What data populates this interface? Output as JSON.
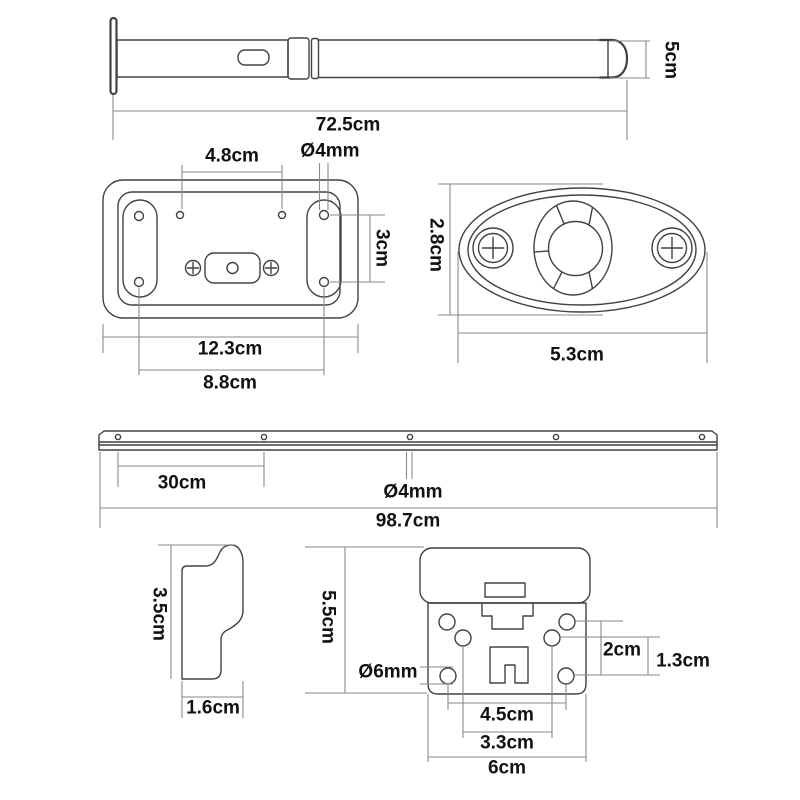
{
  "colors": {
    "background": "#ffffff",
    "outline": "#424242",
    "dimension_line": "#8a8a8a",
    "text": "#111111"
  },
  "figures": {
    "pole": {
      "title": "telescopic pole",
      "length": "72.5cm",
      "diameter": "5cm"
    },
    "plate": {
      "title": "rectangular mounting plate",
      "top_hole_spacing": "4.8cm",
      "hole_diameter": "Ø4mm",
      "side_hole_spacing": "3cm",
      "overall_width": "12.3cm",
      "hole_span": "8.8cm"
    },
    "oval_plate": {
      "title": "oval mounting plate",
      "height": "2.8cm",
      "width": "5.3cm"
    },
    "rail": {
      "title": "mounting rail",
      "hole_spacing": "30cm",
      "hole_diameter": "Ø4mm",
      "length": "98.7cm"
    },
    "profile": {
      "title": "hook profile",
      "height": "3.5cm",
      "depth": "1.6cm"
    },
    "bracket": {
      "title": "mounting bracket",
      "height": "5.5cm",
      "hole_diameter": "Ø6mm",
      "right_hole_gap_outer": "2cm",
      "right_hole_gap_inner": "1.3cm",
      "bottom_hole_span_outer": "4.5cm",
      "bottom_hole_span_inner": "3.3cm",
      "width": "6cm"
    }
  }
}
